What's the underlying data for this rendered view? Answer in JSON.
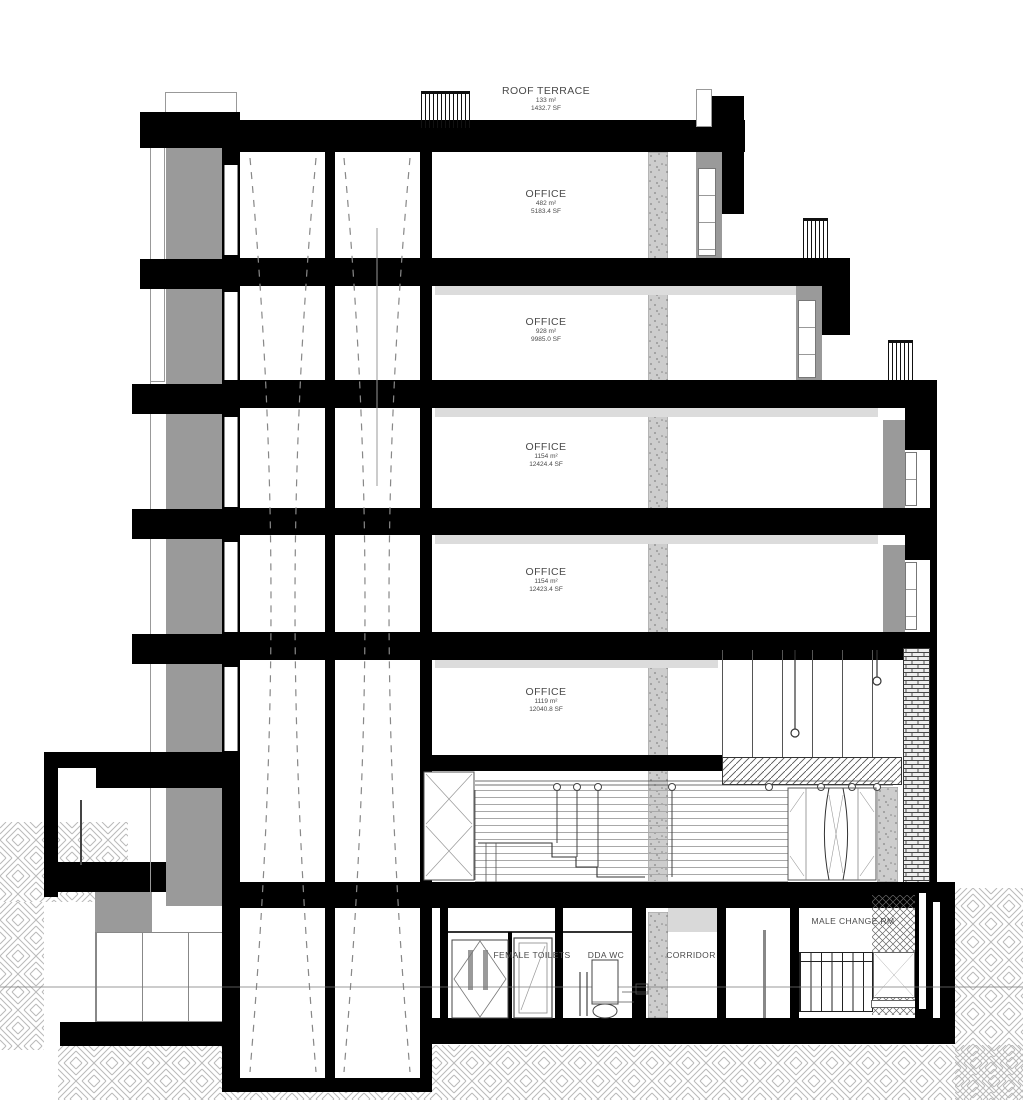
{
  "drawing": {
    "title": "building-section",
    "levels": [
      {
        "label": "ROOF TERRACE",
        "area_m2": "133 m²",
        "area_sf": "1432.7 SF"
      },
      {
        "label": "OFFICE",
        "area_m2": "482 m²",
        "area_sf": "5183.4 SF"
      },
      {
        "label": "OFFICE",
        "area_m2": "928 m²",
        "area_sf": "9985.0 SF"
      },
      {
        "label": "OFFICE",
        "area_m2": "1154 m²",
        "area_sf": "12424.4 SF"
      },
      {
        "label": "OFFICE",
        "area_m2": "1154 m²",
        "area_sf": "12423.4 SF"
      },
      {
        "label": "OFFICE",
        "area_m2": "1119 m²",
        "area_sf": "12040.8 SF"
      }
    ],
    "rooms": {
      "female_toilets": "FEMALE TOILETS",
      "dda_wc": "DDA WC",
      "corridor": "CORRIDOR",
      "male_change": "MALE CHANGE RM"
    },
    "colors": {
      "ink": "#000000",
      "facade_gray": "#9a9a9a",
      "light_gray": "#d9d9d9",
      "concrete": "#cdcdcd",
      "hatch_line": "#b9b9b9",
      "accent_cyan": "#3bc9d8",
      "label_text": "#4a4a4a"
    }
  }
}
